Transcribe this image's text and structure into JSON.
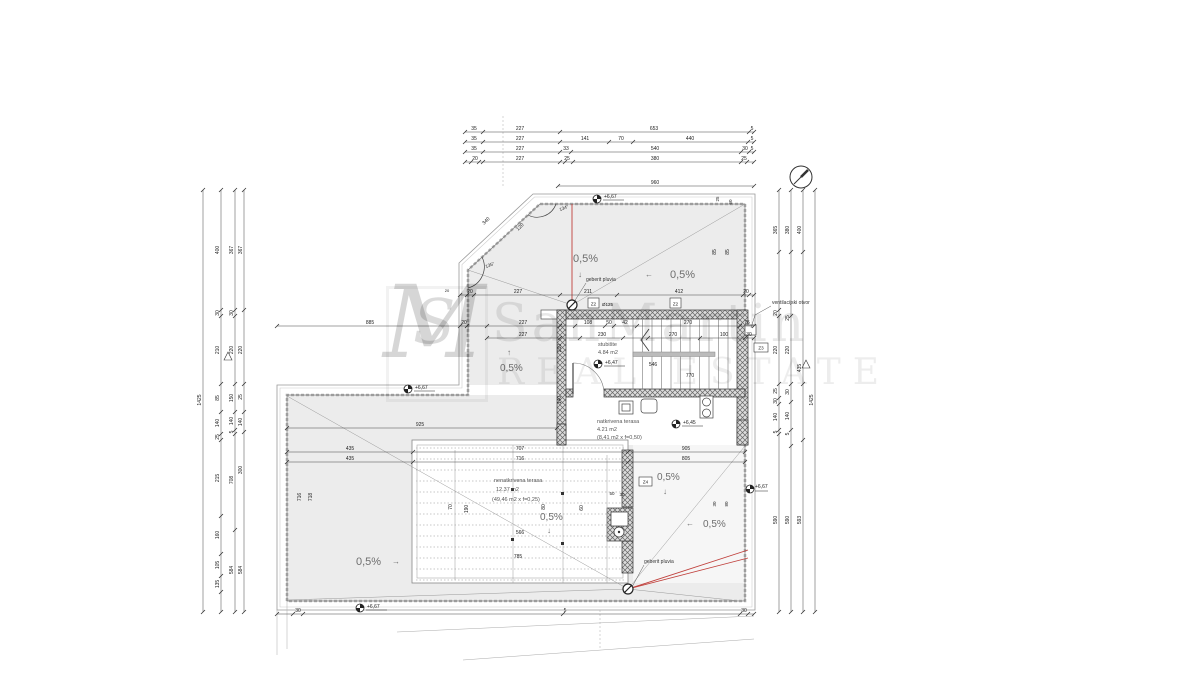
{
  "watermark": {
    "monogram_m": "M",
    "monogram_s": "S",
    "line1": "SanMartin",
    "line2": "REAL ESTATE"
  },
  "rooms": {
    "stubiste": {
      "name": "stubište",
      "area": "4.84 m2"
    },
    "natkrivena": {
      "name": "natkrivena terasa",
      "area": "4.21 m2",
      "factor": "(8,41 m2 x f=0,50)"
    },
    "nenatkrivena": {
      "name": "nenatkrivena terasa",
      "area": "12.37 m2",
      "factor": "(49,46 m2 x f=0,25)"
    }
  },
  "annotations": {
    "slope": "0,5%",
    "arrow_down": "↓",
    "arrow_left": "←",
    "arrow_right": "→",
    "arrow_up": "↑",
    "drain_label": "geberit pluvia",
    "vent_label": "ventilacijski otvor",
    "pipe_label": "Ø125",
    "elev_roof_top": "+6,67",
    "elev_stair": "+6,47",
    "elev_terrace_covered": "+6,45",
    "elev_lower_roof": "+6,67",
    "elev_bottom": "+6,67",
    "elev_right": "+6,67",
    "angle_top": "134°",
    "angle_left": "135°"
  },
  "tags": {
    "z2_left": "Z2",
    "z2_right": "Z2",
    "z3": "Z3",
    "z4": "Z4"
  },
  "dims": {
    "h_rows": [
      {
        "y": 132,
        "x0": 465,
        "x1": 754,
        "ticks": [
          465,
          483,
          560,
          749,
          754
        ],
        "labels": [
          {
            "t": "35",
            "x": 474
          },
          {
            "t": "227",
            "x": 520
          },
          {
            "t": "653",
            "x": 654
          },
          {
            "t": "5",
            "x": 752
          }
        ]
      },
      {
        "y": 142,
        "x0": 465,
        "x1": 754,
        "ticks": [
          465,
          483,
          560,
          609,
          633,
          748,
          754
        ],
        "labels": [
          {
            "t": "35",
            "x": 474
          },
          {
            "t": "227",
            "x": 520
          },
          {
            "t": "141",
            "x": 585
          },
          {
            "t": "70",
            "x": 621
          },
          {
            "t": "440",
            "x": 690
          },
          {
            "t": "5",
            "x": 752
          }
        ]
      },
      {
        "y": 152,
        "x0": 465,
        "x1": 754,
        "ticks": [
          465,
          483,
          560,
          571,
          741,
          749,
          754
        ],
        "labels": [
          {
            "t": "35",
            "x": 474
          },
          {
            "t": "227",
            "x": 520
          },
          {
            "t": "33",
            "x": 566
          },
          {
            "t": "540",
            "x": 655
          },
          {
            "t": "30",
            "x": 745
          },
          {
            "t": "5",
            "x": 752
          }
        ]
      },
      {
        "y": 162,
        "x0": 465,
        "x1": 754,
        "ticks": [
          465,
          471,
          479,
          483,
          560,
          565,
          573,
          741,
          747,
          754
        ],
        "labels": [
          {
            "t": "20",
            "x": 475
          },
          {
            "t": "227",
            "x": 520
          },
          {
            "t": "25",
            "x": 567
          },
          {
            "t": "380",
            "x": 655
          },
          {
            "t": "25",
            "x": 744
          }
        ]
      },
      {
        "y": 186,
        "x0": 558,
        "x1": 754,
        "ticks": [
          558,
          754
        ],
        "labels": [
          {
            "t": "960",
            "x": 655
          }
        ]
      },
      {
        "y": 295,
        "x0": 460,
        "x1": 754,
        "ticks": [
          460,
          467,
          474,
          560,
          617,
          743,
          749,
          754
        ],
        "labels": [
          {
            "t": "20",
            "x": 470
          },
          {
            "t": "227",
            "x": 518
          },
          {
            "t": "211",
            "x": 588
          },
          {
            "t": "412",
            "x": 679
          },
          {
            "t": "20",
            "x": 746
          }
        ]
      },
      {
        "y": 326,
        "x0": 277,
        "x1": 754,
        "ticks": [
          277,
          460,
          467,
          487,
          560,
          575,
          605,
          614,
          637,
          740,
          754
        ],
        "labels": [
          {
            "t": "885",
            "x": 370
          },
          {
            "t": "20",
            "x": 464
          },
          {
            "t": "227",
            "x": 523
          },
          {
            "t": "108",
            "x": 588
          },
          {
            "t": "50",
            "x": 609
          },
          {
            "t": "42",
            "x": 625
          },
          {
            "t": "270",
            "x": 688
          },
          {
            "t": "75",
            "x": 747
          }
        ]
      },
      {
        "y": 338,
        "x0": 487,
        "x1": 754,
        "ticks": [
          487,
          560,
          580,
          623,
          648,
          700,
          745,
          754
        ],
        "labels": [
          {
            "t": "227",
            "x": 523
          },
          {
            "t": "230",
            "x": 602
          },
          {
            "t": "270",
            "x": 673
          },
          {
            "t": "100",
            "x": 724
          },
          {
            "t": "30",
            "x": 749
          }
        ]
      },
      {
        "y": 428,
        "x0": 287,
        "x1": 557,
        "ticks": [
          287,
          557
        ],
        "labels": [
          {
            "t": "925",
            "x": 420
          }
        ]
      },
      {
        "y": 452,
        "x0": 287,
        "x1": 745,
        "ticks": [
          287,
          413,
          628,
          745
        ],
        "labels": [
          {
            "t": "435",
            "x": 350
          },
          {
            "t": "707",
            "x": 520
          },
          {
            "t": "905",
            "x": 686
          }
        ]
      },
      {
        "y": 462,
        "x0": 287,
        "x1": 745,
        "ticks": [
          287,
          413,
          628,
          745
        ],
        "labels": [
          {
            "t": "435",
            "x": 350
          },
          {
            "t": "716",
            "x": 520
          },
          {
            "t": "805",
            "x": 686
          }
        ]
      },
      {
        "y": 614,
        "x0": 277,
        "x1": 754,
        "ticks": [
          277,
          293,
          303,
          563,
          740,
          748,
          754
        ],
        "labels": [
          {
            "t": "30",
            "x": 298
          },
          {
            "t": "5",
            "x": 565
          },
          {
            "t": "30",
            "x": 744
          }
        ]
      }
    ],
    "v_cols": [
      {
        "x": 203,
        "y0": 190,
        "y1": 612,
        "ticks": [
          190,
          612
        ],
        "labels": [
          {
            "t": "1425",
            "y": 400
          }
        ]
      },
      {
        "x": 221,
        "y0": 190,
        "y1": 612,
        "ticks": [
          190,
          310,
          316,
          384,
          412,
          434,
          440,
          516,
          554,
          576,
          592,
          612
        ],
        "labels": [
          {
            "t": "400",
            "y": 250
          },
          {
            "t": "30",
            "y": 313
          },
          {
            "t": "210",
            "y": 350
          },
          {
            "t": "85",
            "y": 398
          },
          {
            "t": "140",
            "y": 423
          },
          {
            "t": "25",
            "y": 437
          },
          {
            "t": "215",
            "y": 478
          },
          {
            "t": "160",
            "y": 535
          },
          {
            "t": "105",
            "y": 565
          },
          {
            "t": "135",
            "y": 584
          }
        ]
      },
      {
        "x": 235,
        "y0": 190,
        "y1": 612,
        "ticks": [
          190,
          310,
          316,
          384,
          412,
          430,
          434,
          530,
          612
        ],
        "labels": [
          {
            "t": "367",
            "y": 250
          },
          {
            "t": "30",
            "y": 313
          },
          {
            "t": "220",
            "y": 350
          },
          {
            "t": "150",
            "y": 398
          },
          {
            "t": "140",
            "y": 421
          },
          {
            "t": "5",
            "y": 432
          },
          {
            "t": "708",
            "y": 480
          },
          {
            "t": "584",
            "y": 570
          }
        ]
      },
      {
        "x": 244,
        "y0": 190,
        "y1": 612,
        "ticks": [
          190,
          310,
          384,
          412,
          432,
          612
        ],
        "labels": [
          {
            "t": "367",
            "y": 250
          },
          {
            "t": "220",
            "y": 350
          },
          {
            "t": "25",
            "y": 397
          },
          {
            "t": "140",
            "y": 422
          },
          {
            "t": "300",
            "y": 470
          },
          {
            "t": "584",
            "y": 570
          }
        ]
      },
      {
        "x": 779,
        "y0": 190,
        "y1": 612,
        "ticks": [
          190,
          252,
          310,
          316,
          384,
          398,
          404,
          430,
          434,
          612
        ],
        "labels": [
          {
            "t": "365",
            "y": 230
          },
          {
            "t": "20",
            "y": 313
          },
          {
            "t": "220",
            "y": 350
          },
          {
            "t": "25",
            "y": 391
          },
          {
            "t": "30",
            "y": 401
          },
          {
            "t": "140",
            "y": 417
          },
          {
            "t": "5",
            "y": 432
          },
          {
            "t": "590",
            "y": 520
          }
        ]
      },
      {
        "x": 791,
        "y0": 190,
        "y1": 612,
        "ticks": [
          190,
          252,
          316,
          384,
          402,
          430,
          446,
          612
        ],
        "labels": [
          {
            "t": "380",
            "y": 230
          },
          {
            "t": "25",
            "y": 318
          },
          {
            "t": "220",
            "y": 350
          },
          {
            "t": "30",
            "y": 392
          },
          {
            "t": "140",
            "y": 416
          },
          {
            "t": "5",
            "y": 434
          },
          {
            "t": "590",
            "y": 520
          }
        ]
      },
      {
        "x": 803,
        "y0": 190,
        "y1": 612,
        "ticks": [
          190,
          252,
          384,
          440,
          612
        ],
        "labels": [
          {
            "t": "400",
            "y": 230
          },
          {
            "t": "435",
            "y": 368
          },
          {
            "t": "593",
            "y": 520
          }
        ]
      },
      {
        "x": 815,
        "y0": 190,
        "y1": 612,
        "ticks": [
          190,
          612
        ],
        "labels": [
          {
            "t": "1425",
            "y": 400
          }
        ]
      }
    ],
    "free": [
      {
        "t": "340",
        "x": 487,
        "y": 222,
        "r": -43
      },
      {
        "t": "120",
        "x": 521,
        "y": 228,
        "r": -43
      },
      {
        "t": "546",
        "x": 653,
        "y": 366
      },
      {
        "t": "770",
        "x": 690,
        "y": 377
      },
      {
        "t": "210",
        "x": 561,
        "y": 348,
        "r": -90
      },
      {
        "t": "140",
        "x": 561,
        "y": 400,
        "r": -90
      },
      {
        "t": "85",
        "x": 716,
        "y": 252,
        "r": -90
      },
      {
        "t": "85",
        "x": 729,
        "y": 252,
        "r": -90
      },
      {
        "t": "25",
        "x": 719,
        "y": 199,
        "r": -90,
        "s": 4.5
      },
      {
        "t": "60",
        "x": 732,
        "y": 202,
        "r": -90,
        "s": 4.5
      },
      {
        "t": "716",
        "x": 301,
        "y": 497,
        "r": -90
      },
      {
        "t": "718",
        "x": 312,
        "y": 497,
        "r": -90
      },
      {
        "t": "70",
        "x": 452,
        "y": 507,
        "r": -90
      },
      {
        "t": "190",
        "x": 468,
        "y": 509,
        "r": -90
      },
      {
        "t": "80",
        "x": 545,
        "y": 507,
        "r": -90
      },
      {
        "t": "60",
        "x": 583,
        "y": 508,
        "r": -90
      },
      {
        "t": "50",
        "x": 612,
        "y": 495,
        "s": 4.5
      },
      {
        "t": "30",
        "x": 622,
        "y": 496,
        "s": 4.5
      },
      {
        "t": "30",
        "x": 716,
        "y": 504,
        "r": -90,
        "s": 4.5
      },
      {
        "t": "80",
        "x": 728,
        "y": 504,
        "r": -90,
        "s": 4.5
      },
      {
        "t": "566",
        "x": 520,
        "y": 534
      },
      {
        "t": "785",
        "x": 518,
        "y": 558
      },
      {
        "t": "20",
        "x": 447,
        "y": 292,
        "s": 4
      }
    ]
  }
}
